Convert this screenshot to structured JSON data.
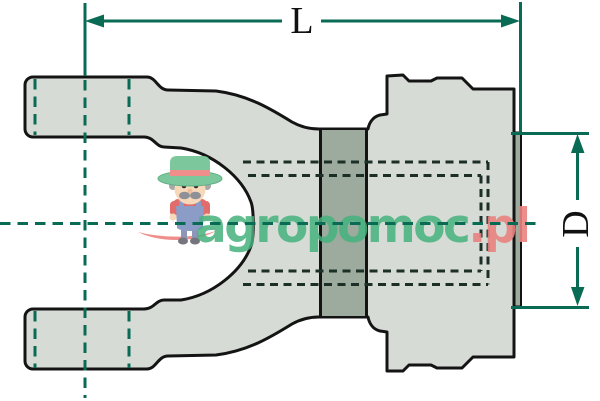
{
  "dimensions": {
    "length_label": "L",
    "diameter_label": "D"
  },
  "watermark": {
    "brand_green": "agropomoc",
    "brand_red": ".pl",
    "mascot": "farmer-mascot"
  },
  "colors": {
    "background": "#ffffff",
    "outline": "#141414",
    "body_fill": "#d6dbd5",
    "collar_fill": "#9cab9e",
    "dimension_teal": "#0a6b55",
    "hidden_line": "#1c2f27",
    "watermark_green": "#45b17d",
    "watermark_red": "#e98280"
  }
}
